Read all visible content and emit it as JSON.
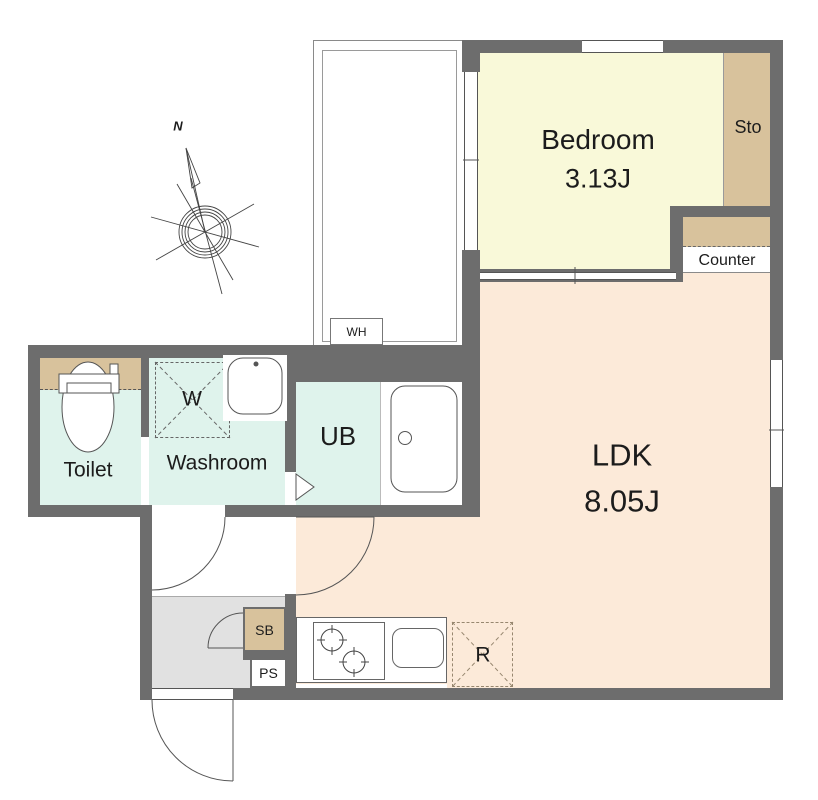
{
  "colors": {
    "wall": "#6d6d6d",
    "bedroom_fill": "#f9f9d9",
    "ldk_fill": "#fcead9",
    "wet_fill": "#dff3ec",
    "wood_fill": "#d8c29c",
    "entry_fill": "#e1e1e1"
  },
  "compass": {
    "north_label": "N"
  },
  "rooms": {
    "bedroom": {
      "name": "Bedroom",
      "size": "3.13J"
    },
    "ldk": {
      "name": "LDK",
      "size": "8.05J"
    },
    "toilet": {
      "name": "Toilet"
    },
    "washroom": {
      "name": "Washroom"
    },
    "unit_bath": {
      "name": "UB"
    },
    "storage": {
      "name": "Sto"
    },
    "counter": {
      "name": "Counter"
    }
  },
  "fixtures": {
    "washing_machine": {
      "label": "W"
    },
    "water_heater": {
      "label": "WH"
    },
    "shoe_box": {
      "label": "SB"
    },
    "pipe_space": {
      "label": "PS"
    },
    "refrigerator": {
      "label": "R"
    }
  }
}
